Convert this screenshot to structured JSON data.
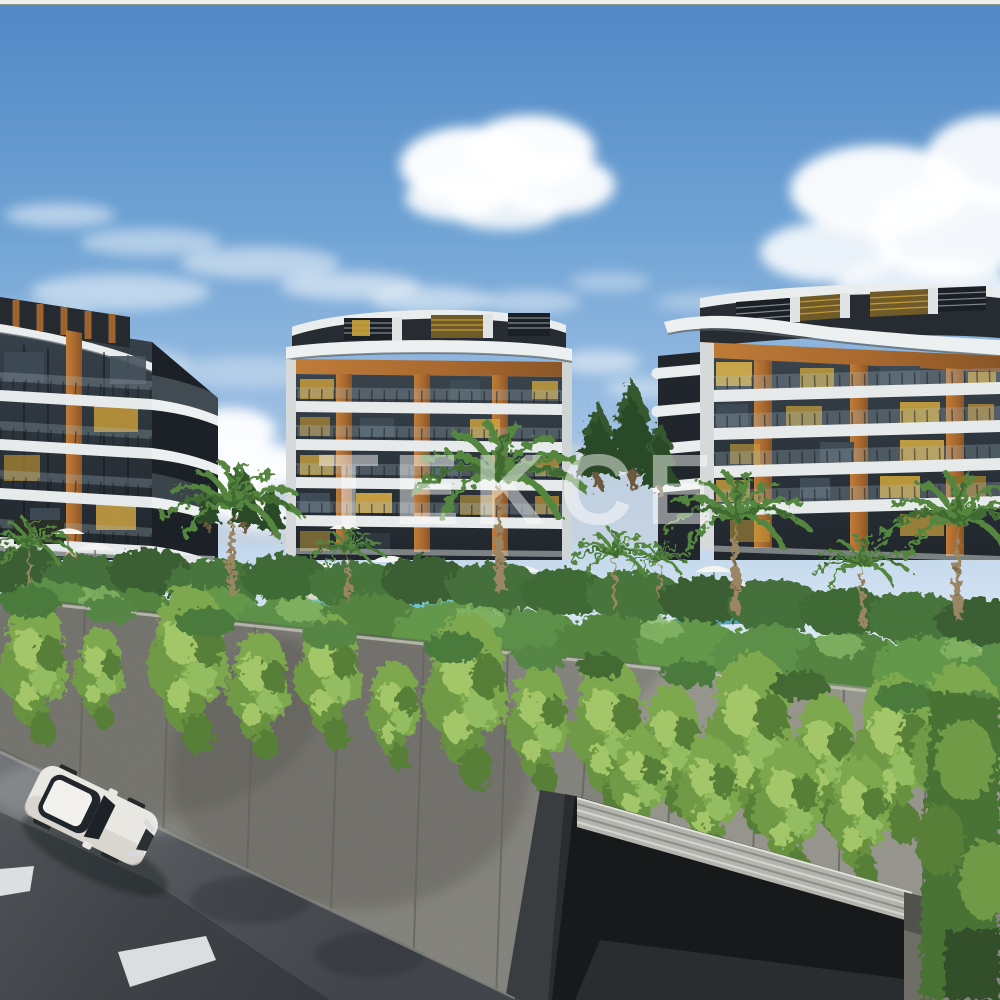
{
  "page": {
    "type": "architectural-rendering",
    "title": "Residential complex exterior render"
  },
  "watermark": {
    "text": "TEKCE",
    "color": "#ffffff"
  },
  "palette": {
    "sky_top": "#5187c5",
    "sky_horizon": "#eff5fa",
    "cloud": "#ffffff",
    "roof_white": "#eaeded",
    "slab_white": "#e7eaea",
    "facade_glass": "#2b333b",
    "wood_accent": "#a9692f",
    "lit_window": "#caa23c",
    "palm_green": "#55863f",
    "bush_green": "#47743a",
    "ivy_green": "#7da84e",
    "pine_green": "#2c4a28",
    "pool_water": "#5fb8c9",
    "wall_concrete": "#908f87",
    "wall_joint": "#63635c",
    "road_asphalt": "#4a4f56",
    "road_marking": "#e4e7e7",
    "car_body": "#e9e7e2",
    "car_glass": "#20262c",
    "garage_beam": "#b5b5b0",
    "garage_shadow": "#17191b"
  },
  "scene_elements": [
    "sky",
    "clouds",
    "distant-mountains",
    "apartment-building-left",
    "apartment-building-middle",
    "apartment-building-right",
    "pine-trees",
    "palm-trees",
    "garden-bushes",
    "swimming-pool",
    "sun-umbrellas",
    "sun-loungers",
    "people",
    "perimeter-wall",
    "ivy",
    "road",
    "road-markings",
    "white-car",
    "underground-garage-ramp"
  ]
}
